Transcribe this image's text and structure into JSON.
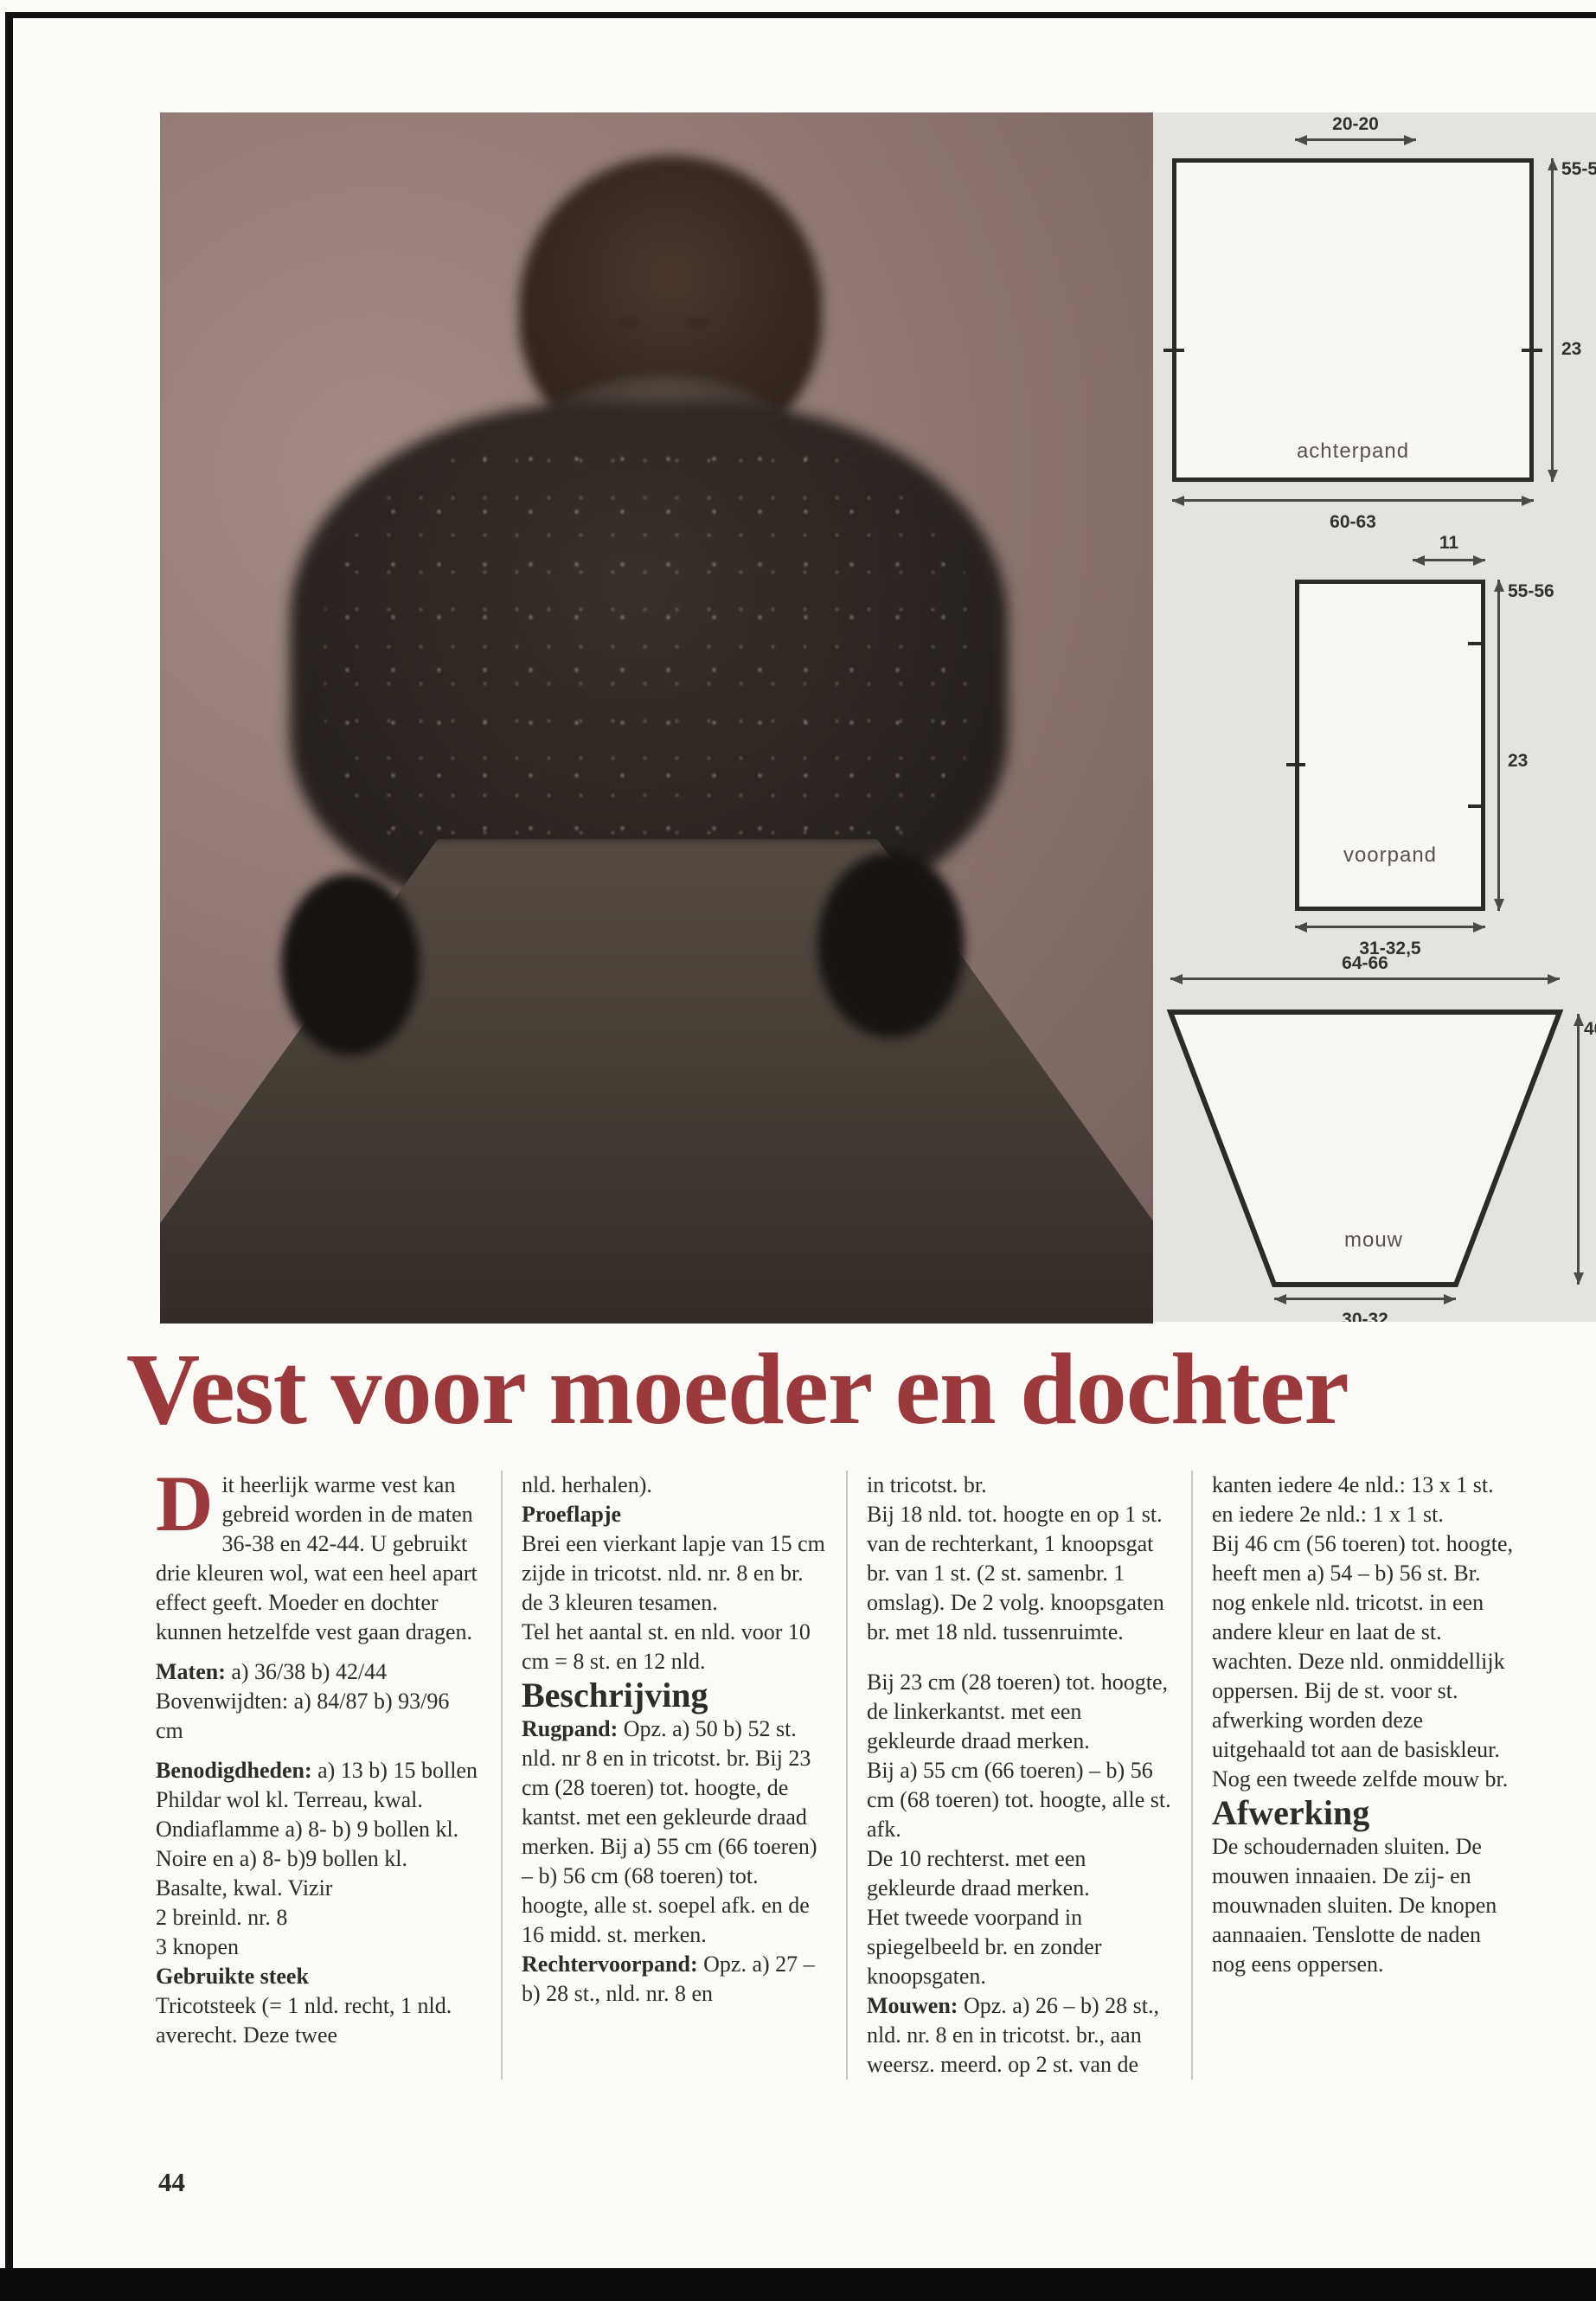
{
  "page": {
    "number": "44"
  },
  "title": "Vest voor moeder en dochter",
  "colors": {
    "title_red": "#9a3a3c",
    "panel_gray": "#e4e3de",
    "photo_mauve": "#8e7772",
    "diagram_stroke": "#2d2b27"
  },
  "diagrams": {
    "achterpand": {
      "label": "achterpand",
      "width_top": "20-20",
      "height_right": "55-56",
      "armhole_right": "23",
      "width_bottom": "60-63"
    },
    "voorpand": {
      "label": "voorpand",
      "width_top": "11",
      "height_right": "55-56",
      "armhole_right": "23",
      "width_bottom": "31-32,5"
    },
    "mouw": {
      "label": "mouw",
      "width_top": "64-66",
      "height_right": "46",
      "width_bottom": "30-32"
    }
  },
  "columns": {
    "col1": {
      "dropcap": "D",
      "intro": "it heerlijk warme vest kan gebreid worden in de maten 36-38 en 42-44. U gebruikt drie kleuren wol, wat een heel apart effect geeft. Moeder en dochter kunnen hetzelfde vest gaan dragen.",
      "maten_label": "Maten:",
      "maten_text": " a) 36/38 b) 42/44 Bovenwijdten: a) 84/87 b) 93/96 cm",
      "benodigdheden_label": "Benodigdheden:",
      "benodigdheden_text": " a) 13 b) 15 bollen Phildar wol kl. Terreau, kwal. Ondiaflamme a) 8- b) 9 bollen kl. Noire en a) 8- b)9 bollen kl. Basalte, kwal. Vizir",
      "naalden": "2 breinld. nr. 8",
      "knopen": "3 knopen",
      "steek_heading": "Gebruikte steek",
      "steek_text": "Tricotsteek (= 1 nld. recht, 1 nld. averecht. Deze twee"
    },
    "col2": {
      "cont": "nld. herhalen).",
      "proeflapje_heading": "Proeflapje",
      "proeflapje_p1": "Brei een vierkant lapje van 15 cm zijde in tricotst. nld. nr. 8 en br. de 3 kleuren tesamen.",
      "proeflapje_p2": "Tel het aantal st. en nld. voor 10 cm = 8 st. en 12 nld.",
      "beschrijving_heading": "Beschrijving",
      "rugpand_label": "Rugpand:",
      "rugpand_text": " Opz. a) 50 b) 52 st. nld. nr 8 en in tricotst. br. Bij 23 cm (28 toeren) tot. hoogte, de kantst. met een gekleurde draad merken. Bij a) 55 cm (66 toeren) – b) 56 cm (68 toeren) tot. hoogte, alle st. soepel afk. en de 16 midd. st. merken.",
      "rechtervoorpand_label": "Rechtervoorpand:",
      "rechtervoorpand_text": " Opz. a) 27 – b) 28 st., nld. nr. 8 en"
    },
    "col3": {
      "p1": "in tricotst. br.",
      "p2": "Bij 18 nld. tot. hoogte en op 1 st. van de rechterkant, 1 knoopsgat br. van 1 st. (2 st. samenbr. 1 omslag). De 2 volg. knoopsgaten br. met 18 nld. tussenruimte.",
      "p3": "Bij 23 cm (28 toeren) tot. hoogte, de linkerkantst. met een gekleurde draad merken.",
      "p4": "Bij a) 55 cm (66 toeren) – b) 56 cm (68 toeren) tot. hoogte, alle st. afk.",
      "p5": "De 10 rechterst. met een gekleurde draad merken.",
      "p6": "Het tweede voorpand in spiegelbeeld br. en zonder knoopsgaten.",
      "mouwen_label": "Mouwen:",
      "mouwen_text": " Opz. a) 26 – b) 28 st., nld. nr. 8 en in tricotst. br., aan weersz. meerd. op 2 st. van de"
    },
    "col4": {
      "p1": "kanten iedere 4e nld.: 13 x 1 st. en iedere 2e nld.: 1 x 1 st.",
      "p2": "Bij 46 cm (56 toeren) tot. hoogte, heeft men a) 54 – b) 56 st. Br. nog enkele nld. tricotst. in een andere kleur en laat de st. wachten. Deze nld. onmiddellijk oppersen. Bij de st. voor st. afwerking worden deze uitgehaald tot aan de basiskleur.",
      "p3": "Nog een tweede zelfde mouw br.",
      "afwerking_heading": "Afwerking",
      "afwerking_text": "De schoudernaden sluiten. De mouwen innaaien. De zij- en mouwnaden sluiten. De knopen aannaaien. Tenslotte de naden nog eens oppersen."
    }
  }
}
